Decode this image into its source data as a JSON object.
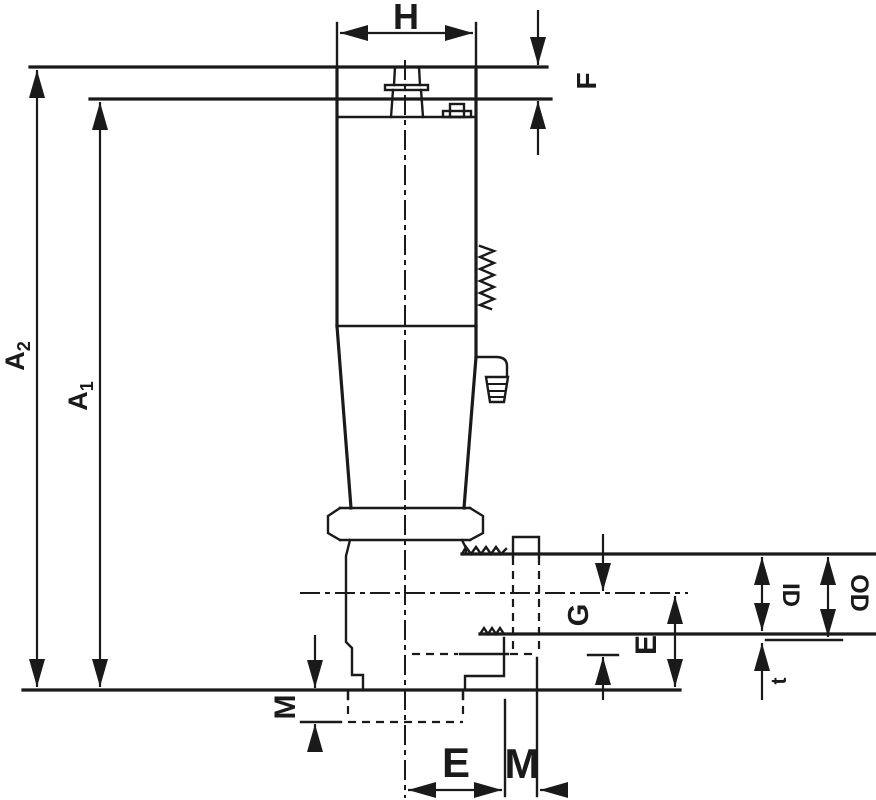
{
  "drawing": {
    "type": "engineering-dimension-drawing",
    "view": "front-elevation",
    "background": "#ffffff",
    "line_color": "#1a1a1a"
  },
  "labels": {
    "h": "H",
    "f": "F",
    "a2_base": "A",
    "a2_sub": "2",
    "a1_base": "A",
    "a1_sub": "1",
    "m_left": "M",
    "g": "G",
    "e_right": "E",
    "id_label": "ID",
    "od_label": "OD",
    "t": "t",
    "e_bottom": "E",
    "m_bottom": "M"
  },
  "dimensions": [
    {
      "label": "H",
      "orientation": "horizontal",
      "location": "top",
      "measures": "cap width"
    },
    {
      "label": "F",
      "orientation": "vertical",
      "location": "top-right",
      "measures": "cap step height"
    },
    {
      "label": "A2",
      "orientation": "vertical",
      "location": "left",
      "measures": "overall height to top face"
    },
    {
      "label": "A1",
      "orientation": "vertical",
      "location": "left",
      "measures": "height to second face"
    },
    {
      "label": "M",
      "orientation": "vertical",
      "location": "bottom-left",
      "measures": "bottom stub length"
    },
    {
      "label": "G",
      "orientation": "vertical",
      "location": "right",
      "measures": "port centerline to hidden shoulder"
    },
    {
      "label": "E",
      "orientation": "vertical",
      "location": "right",
      "measures": "port centerline to base"
    },
    {
      "label": "ID",
      "orientation": "vertical",
      "location": "right",
      "measures": "port inner diameter"
    },
    {
      "label": "OD",
      "orientation": "vertical",
      "location": "right",
      "measures": "port outer diameter"
    },
    {
      "label": "t",
      "orientation": "vertical",
      "location": "bottom-right",
      "measures": "wall thickness"
    },
    {
      "label": "E",
      "orientation": "horizontal",
      "location": "bottom",
      "measures": "centerline to edge"
    },
    {
      "label": "M",
      "orientation": "horizontal",
      "location": "bottom",
      "measures": "edge offset"
    }
  ]
}
